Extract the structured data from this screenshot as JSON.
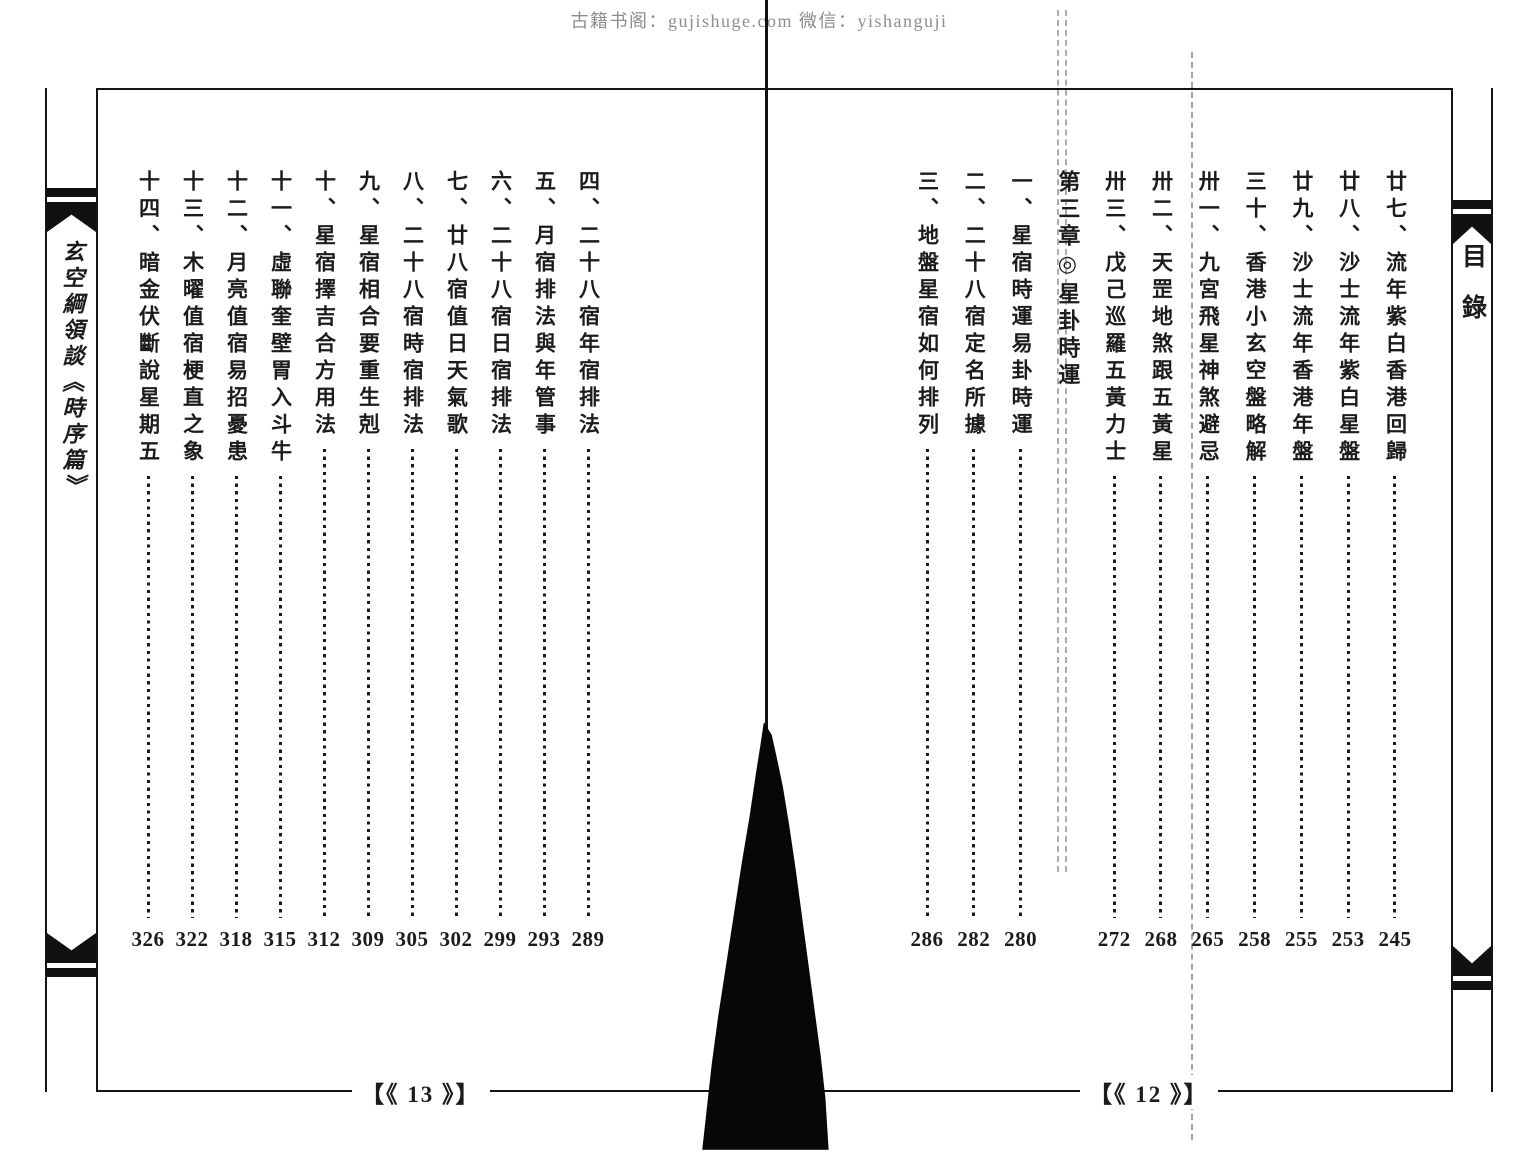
{
  "watermark": "古籍书阁：gujishuge.com 微信：yishanguji",
  "left_spine": {
    "title": "玄空綱領談《時序篇》"
  },
  "right_spine": {
    "title": "目錄"
  },
  "right_page": {
    "footer": "【《 12 》】",
    "entries": [
      {
        "title": "廿七、流年紫白香港回歸",
        "page": "245"
      },
      {
        "title": "廿八、沙士流年紫白星盤",
        "page": "253"
      },
      {
        "title": "廿九、沙士流年香港年盤",
        "page": "255"
      },
      {
        "title": "三十、香港小玄空盤略解",
        "page": "258"
      },
      {
        "title": "卅一、九宮飛星神煞避忌",
        "page": "265"
      },
      {
        "title": "卅二、天罡地煞跟五黃星",
        "page": "268"
      },
      {
        "title": "卅三、戊己巡羅五黃力士",
        "page": "272"
      },
      {
        "title": "第三章◎星卦時運",
        "page": ""
      },
      {
        "title": "一、星宿時運易卦時運",
        "page": "280"
      },
      {
        "title": "二、二十八宿定名所據",
        "page": "282"
      },
      {
        "title": "三、地盤星宿如何排列",
        "page": "286"
      }
    ]
  },
  "left_page": {
    "footer": "【《 13 》】",
    "entries": [
      {
        "title": "四、二十八宿年宿排法",
        "page": "289"
      },
      {
        "title": "五、月宿排法與年管事",
        "page": "293"
      },
      {
        "title": "六、二十八宿日宿排法",
        "page": "299"
      },
      {
        "title": "七、廿八宿值日天氣歌",
        "page": "302"
      },
      {
        "title": "八、二十八宿時宿排法",
        "page": "305"
      },
      {
        "title": "九、星宿相合要重生剋",
        "page": "309"
      },
      {
        "title": "十、星宿擇吉合方用法",
        "page": "312"
      },
      {
        "title": "十一、虛聯奎壁胃入斗牛",
        "page": "315"
      },
      {
        "title": "十二、月亮值宿易招憂患",
        "page": "318"
      },
      {
        "title": "十三、木曜值宿梗直之象",
        "page": "322"
      },
      {
        "title": "十四、暗金伏斷說星期五",
        "page": "326"
      }
    ]
  }
}
